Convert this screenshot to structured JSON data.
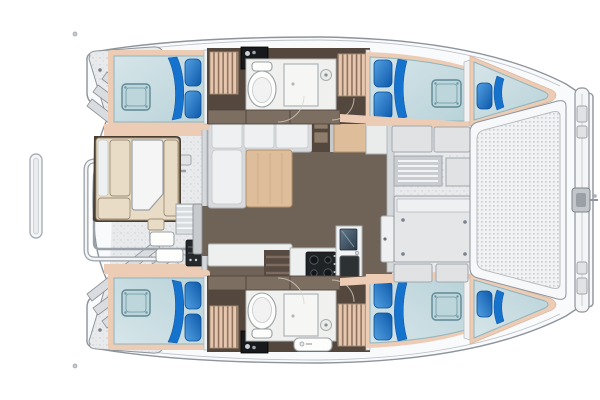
{
  "meta": {
    "title": "Catamaran yacht interior layout - top-down floor plan, bow to the right"
  },
  "colors": {
    "hull": "#f9fafb",
    "outline": "#8d949c",
    "deck": "#e8eaec",
    "deckDot": "#c9ccd0",
    "peach": "#edccb5",
    "floor": "#6f6257",
    "cabinetDark": "#54473d",
    "cabinet": "#7d6e62",
    "stepBg": "#e6c6ae",
    "stepStripe": "#8a6f5b",
    "bedLight": "#d6e5e9",
    "bedDark": "#b9d3d9",
    "bedEdge": "#8fb4bd",
    "pillowLight": "#53a0e2",
    "pillowDark": "#0c58aa",
    "swoosh": "#1573cd",
    "hatchBlue": "#bcd6dc",
    "hatchEdge": "#5f8894",
    "wood": "#ddbd9a",
    "settee": "#d8dadd",
    "cushion": "#eef0f1",
    "cream": "#e8dcc6",
    "bath": "#f0f1ee",
    "stove": "#1f2326",
    "grill": "#26292c",
    "mesh": "#f1f2f3",
    "meshDot": "#cdd0d4",
    "screenTop": "#61798c",
    "screenBottom": "#2b3a47"
  },
  "layout": {
    "orientation": {
      "bow": "right",
      "stern": "left"
    },
    "salon": {
      "furniture": [
        "l-settee",
        "coffee-table",
        "side-cabinet",
        "corner-cabinet",
        "galley-counter",
        "stove",
        "sink",
        "fridge",
        "aft-sliding-door",
        "forward-door"
      ]
    },
    "port_hull": {
      "rooms": [
        "aft-double-berth",
        "head-with-shower",
        "companionway-steps",
        "forward-double-berth",
        "bow-single-berth"
      ],
      "pillows": 5,
      "deck_hatches": 2
    },
    "starboard_hull": {
      "rooms": [
        "aft-double-berth",
        "head-with-shower-and-sink",
        "companionway-steps",
        "forward-double-berth",
        "bow-single-berth"
      ],
      "pillows": 5,
      "deck_hatches": 2
    },
    "aft_cockpit": {
      "items": [
        "l-bench",
        "cockpit-table",
        "side-steps",
        "winches",
        "grill",
        "stern-rail",
        "swim-ladder"
      ]
    },
    "stern": {
      "items": [
        "port-swim-platform",
        "starboard-swim-platform",
        "transom-steps"
      ]
    },
    "foredeck": {
      "items": [
        "bench-lockers",
        "louvered-hatch",
        "deck-locker",
        "large-storage-hatch"
      ]
    },
    "bow": {
      "items": [
        "trampoline",
        "forward-crossbeam",
        "bridle-fitting"
      ]
    }
  }
}
